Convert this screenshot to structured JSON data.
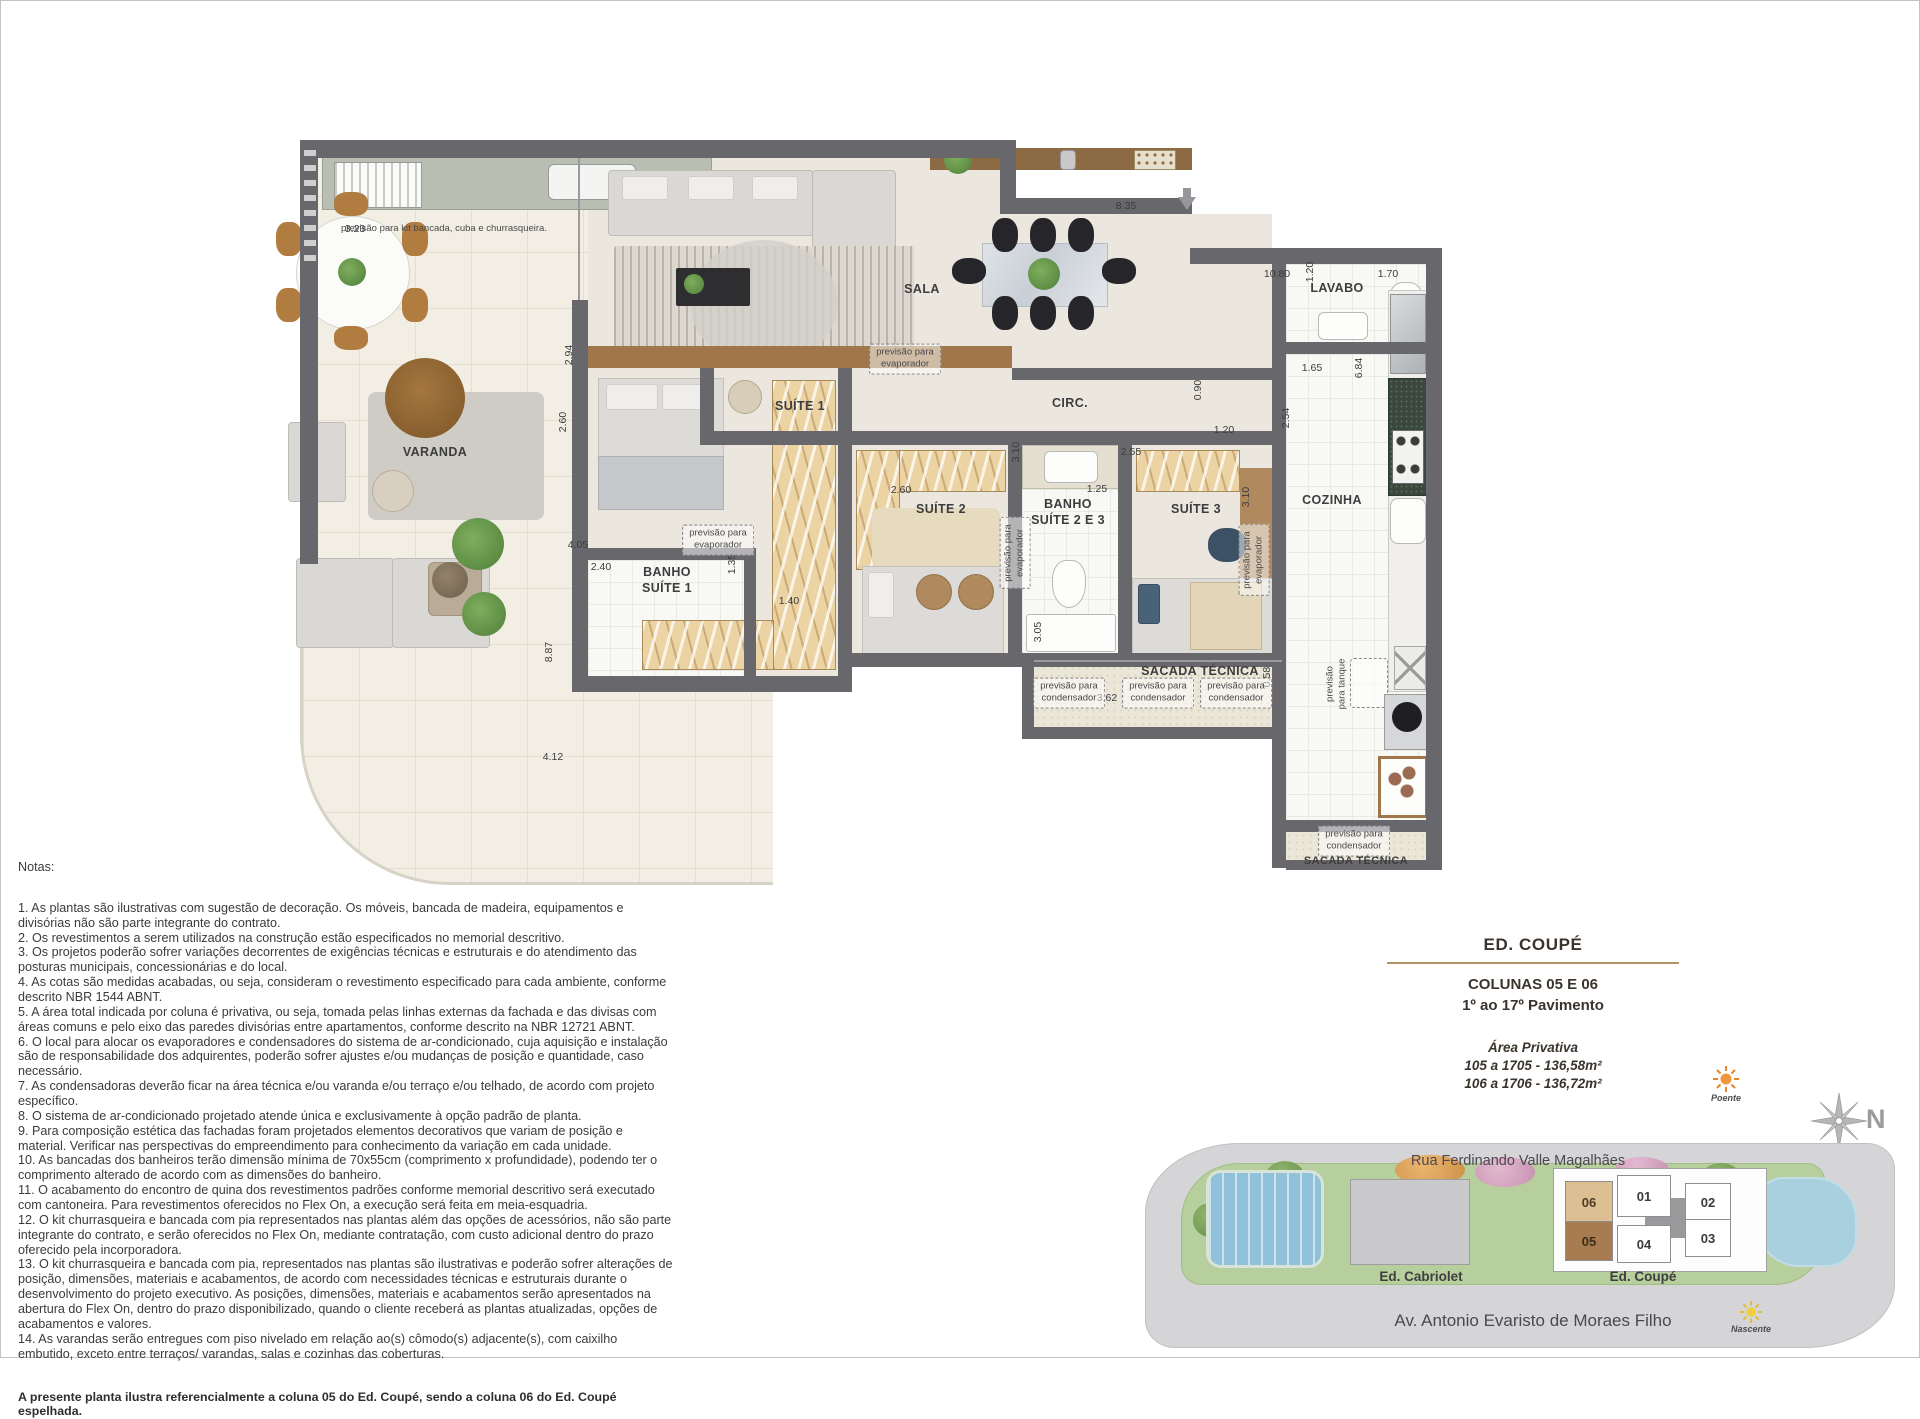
{
  "floorplan": {
    "room_labels": [
      {
        "text": "VARANDA"
      },
      {
        "text": "SALA"
      },
      {
        "text": "SUÍTE 1"
      },
      {
        "text": "CIRC."
      },
      {
        "text": "LAVABO"
      },
      {
        "text": "COZINHA"
      },
      {
        "text": "SUÍTE 2"
      },
      {
        "text": "BANHO\nSUÍTE 2 E 3"
      },
      {
        "text": "SUÍTE 3"
      },
      {
        "text": "BANHO\nSUÍTE 1"
      },
      {
        "text": "SACADA TÉCNICA"
      },
      {
        "text": "SACADA TÉCNICA"
      }
    ],
    "dimensions": [
      {
        "text": "3.23"
      },
      {
        "text": "8.35"
      },
      {
        "text": "10.80"
      },
      {
        "text": "1.20"
      },
      {
        "text": "1.70"
      },
      {
        "text": "2.94"
      },
      {
        "text": "2.60"
      },
      {
        "text": "1.65"
      },
      {
        "text": "6.84"
      },
      {
        "text": "0.90"
      },
      {
        "text": "2.54"
      },
      {
        "text": "1.20"
      },
      {
        "text": "2.55"
      },
      {
        "text": "3.10"
      },
      {
        "text": "3.10"
      },
      {
        "text": "2.60"
      },
      {
        "text": "1.25"
      },
      {
        "text": "4.05"
      },
      {
        "text": "2.40"
      },
      {
        "text": "1.35"
      },
      {
        "text": "1.40"
      },
      {
        "text": "3.05"
      },
      {
        "text": "8.87"
      },
      {
        "text": "0.58"
      },
      {
        "text": "3.62"
      },
      {
        "text": "4.12"
      }
    ],
    "annotations": [
      {
        "text": "previsão para kit bancada, cuba e churrasqueira."
      },
      {
        "text": "previsão para\nevaporador"
      },
      {
        "text": "previsão para\nevaporador"
      },
      {
        "text": "previsão para\nevaporador"
      },
      {
        "text": "previsão para\nevaporador"
      },
      {
        "text": "previsão\npara tanque"
      },
      {
        "text": "previsão para\ncondensador"
      },
      {
        "text": "previsão para\ncondensador"
      },
      {
        "text": "previsão para\ncondensador"
      },
      {
        "text": "previsão para\ncondensador"
      }
    ]
  },
  "notes": {
    "heading": "Notas:",
    "items": [
      "1. As plantas são ilustrativas com sugestão de decoração. Os móveis, bancada de madeira, equipamentos e divisórias não são parte integrante do contrato.",
      "2. Os revestimentos a serem utilizados na construção estão especificados no memorial descritivo.",
      "3. Os projetos poderão sofrer variações decorrentes de exigências técnicas e estruturais e do atendimento das posturas municipais, concessionárias e do local.",
      "4. As cotas são medidas acabadas, ou seja, consideram o revestimento especificado para cada ambiente, conforme descrito NBR 1544 ABNT.",
      "5. A área total indicada por coluna é privativa, ou seja, tomada pelas linhas externas da fachada e das divisas com áreas comuns e pelo eixo das paredes divisórias entre apartamentos, conforme descrito na NBR 12721 ABNT.",
      "6. O local para alocar os evaporadores e condensadores do sistema de ar-condicionado, cuja aquisição e instalação são de responsabilidade dos adquirentes, poderão sofrer ajustes e/ou mudanças de posição e quantidade, caso necessário.",
      "7. As condensadoras deverão ficar na área técnica e/ou varanda e/ou terraço e/ou telhado, de acordo com projeto específico.",
      "8. O sistema de ar-condicionado projetado atende única e exclusivamente à opção padrão de planta.",
      "9. Para composição estética das fachadas foram projetados elementos decorativos que variam de posição e material. Verificar nas perspectivas do empreendimento para conhecimento da variação em cada unidade.",
      "10. As bancadas dos banheiros terão dimensão mínima de 70x55cm (comprimento x profundidade), podendo ter o comprimento alterado de acordo com as dimensões do banheiro.",
      "11. O acabamento do encontro de quina dos revestimentos padrões conforme memorial descritivo será executado com cantoneira. Para revestimentos oferecidos no Flex On, a execução será feita em meia-esquadria.",
      "12. O kit churrasqueira e bancada com pia representados nas plantas além das opções de acessórios, não são parte integrante do contrato, e serão oferecidos no Flex On, mediante contratação, com custo adicional dentro do prazo oferecido pela incorporadora.",
      "13. O kit churrasqueira e bancada com pia, representados nas plantas são ilustrativas e poderão sofrer alterações de posição, dimensões, materiais e acabamentos, de acordo com necessidades técnicas e estruturais durante o desenvolvimento do projeto executivo. As posições, dimensões, materiais e acabamentos serão apresentados na abertura do Flex On, dentro do prazo disponibilizado, quando o cliente receberá as plantas atualizadas, opções de acabamentos e valores.",
      "14. As varandas serão entregues com piso nivelado em relação ao(s) cômodo(s) adjacente(s), com caixilho embutido, exceto entre terraços/ varandas, salas e cozinhas das coberturas."
    ],
    "footer": "A presente planta ilustra referencialmente a coluna 05 do Ed. Coupé, sendo a coluna 06 do Ed. Coupé espelhada."
  },
  "title_block": {
    "building": "ED. COUPÉ",
    "columns": "COLUNAS 05 E 06",
    "floors": "1º ao 17º Pavimento",
    "area_heading": "Área Privativa",
    "area_lines": [
      "105 a 1705 - 136,58m²",
      "106 a 1706 - 136,72m²"
    ],
    "rule_color": "#b29468"
  },
  "site_plan": {
    "street_top": "Rua Ferdinando Valle Magalhães",
    "street_bottom": "Av. Antonio Evaristo de Moraes Filho",
    "buildings": [
      {
        "name": "Ed. Cabriolet"
      },
      {
        "name": "Ed. Coupé"
      }
    ],
    "units": [
      {
        "label": "06",
        "highlight": "light"
      },
      {
        "label": "01",
        "highlight": "none"
      },
      {
        "label": "02",
        "highlight": "none"
      },
      {
        "label": "05",
        "highlight": "dark"
      },
      {
        "label": "04",
        "highlight": "none"
      },
      {
        "label": "03",
        "highlight": "none"
      }
    ],
    "unit_highlight_light": "#dcc094",
    "unit_highlight_dark": "#a87c50",
    "sun_west_label": "Poente",
    "sun_east_label": "Nascente",
    "compass_label": "N"
  }
}
